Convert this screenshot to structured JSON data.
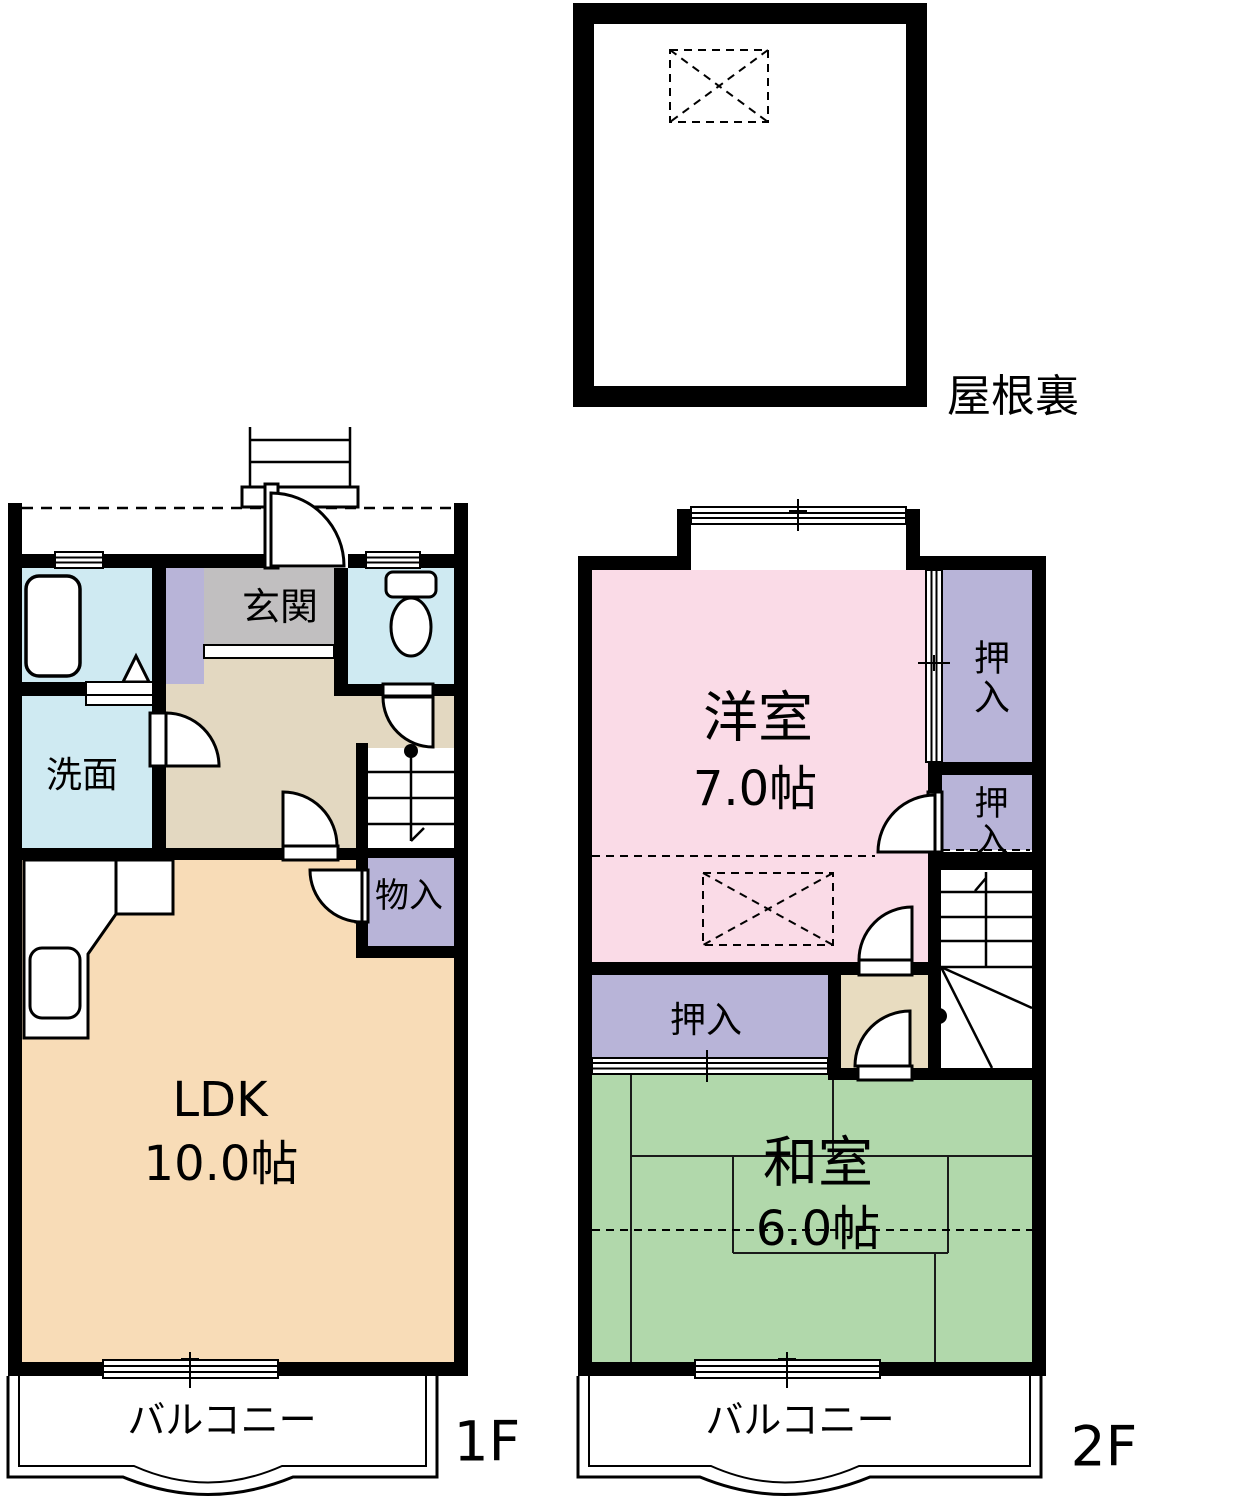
{
  "colors": {
    "wall": "#000000",
    "water_room_blue": "#cfeaf2",
    "closet_lavender": "#b8b4d8",
    "entrance_gray": "#c1bfc0",
    "hall_tan": "#e3d8c1",
    "ldk_peach": "#f8dcb7",
    "western_room_pink": "#fadbe7",
    "tatami_green": "#b1d8ab",
    "landing_tan": "#e8dcc0"
  },
  "attic": {
    "label": "屋根裏"
  },
  "floor1": {
    "label": "1F",
    "entrance": "玄関",
    "washroom": "洗面",
    "storage": "物入",
    "ldk_name": "LDK",
    "ldk_size": "10.0帖",
    "balcony": "バルコニー"
  },
  "floor2": {
    "label": "2F",
    "western_name": "洋室",
    "western_size": "7.0帖",
    "closet_right_upper": "押入",
    "closet_right_lower": "押入",
    "closet_middle": "押入",
    "tatami_name": "和室",
    "tatami_size": "6.0帖",
    "balcony": "バルコニー"
  }
}
